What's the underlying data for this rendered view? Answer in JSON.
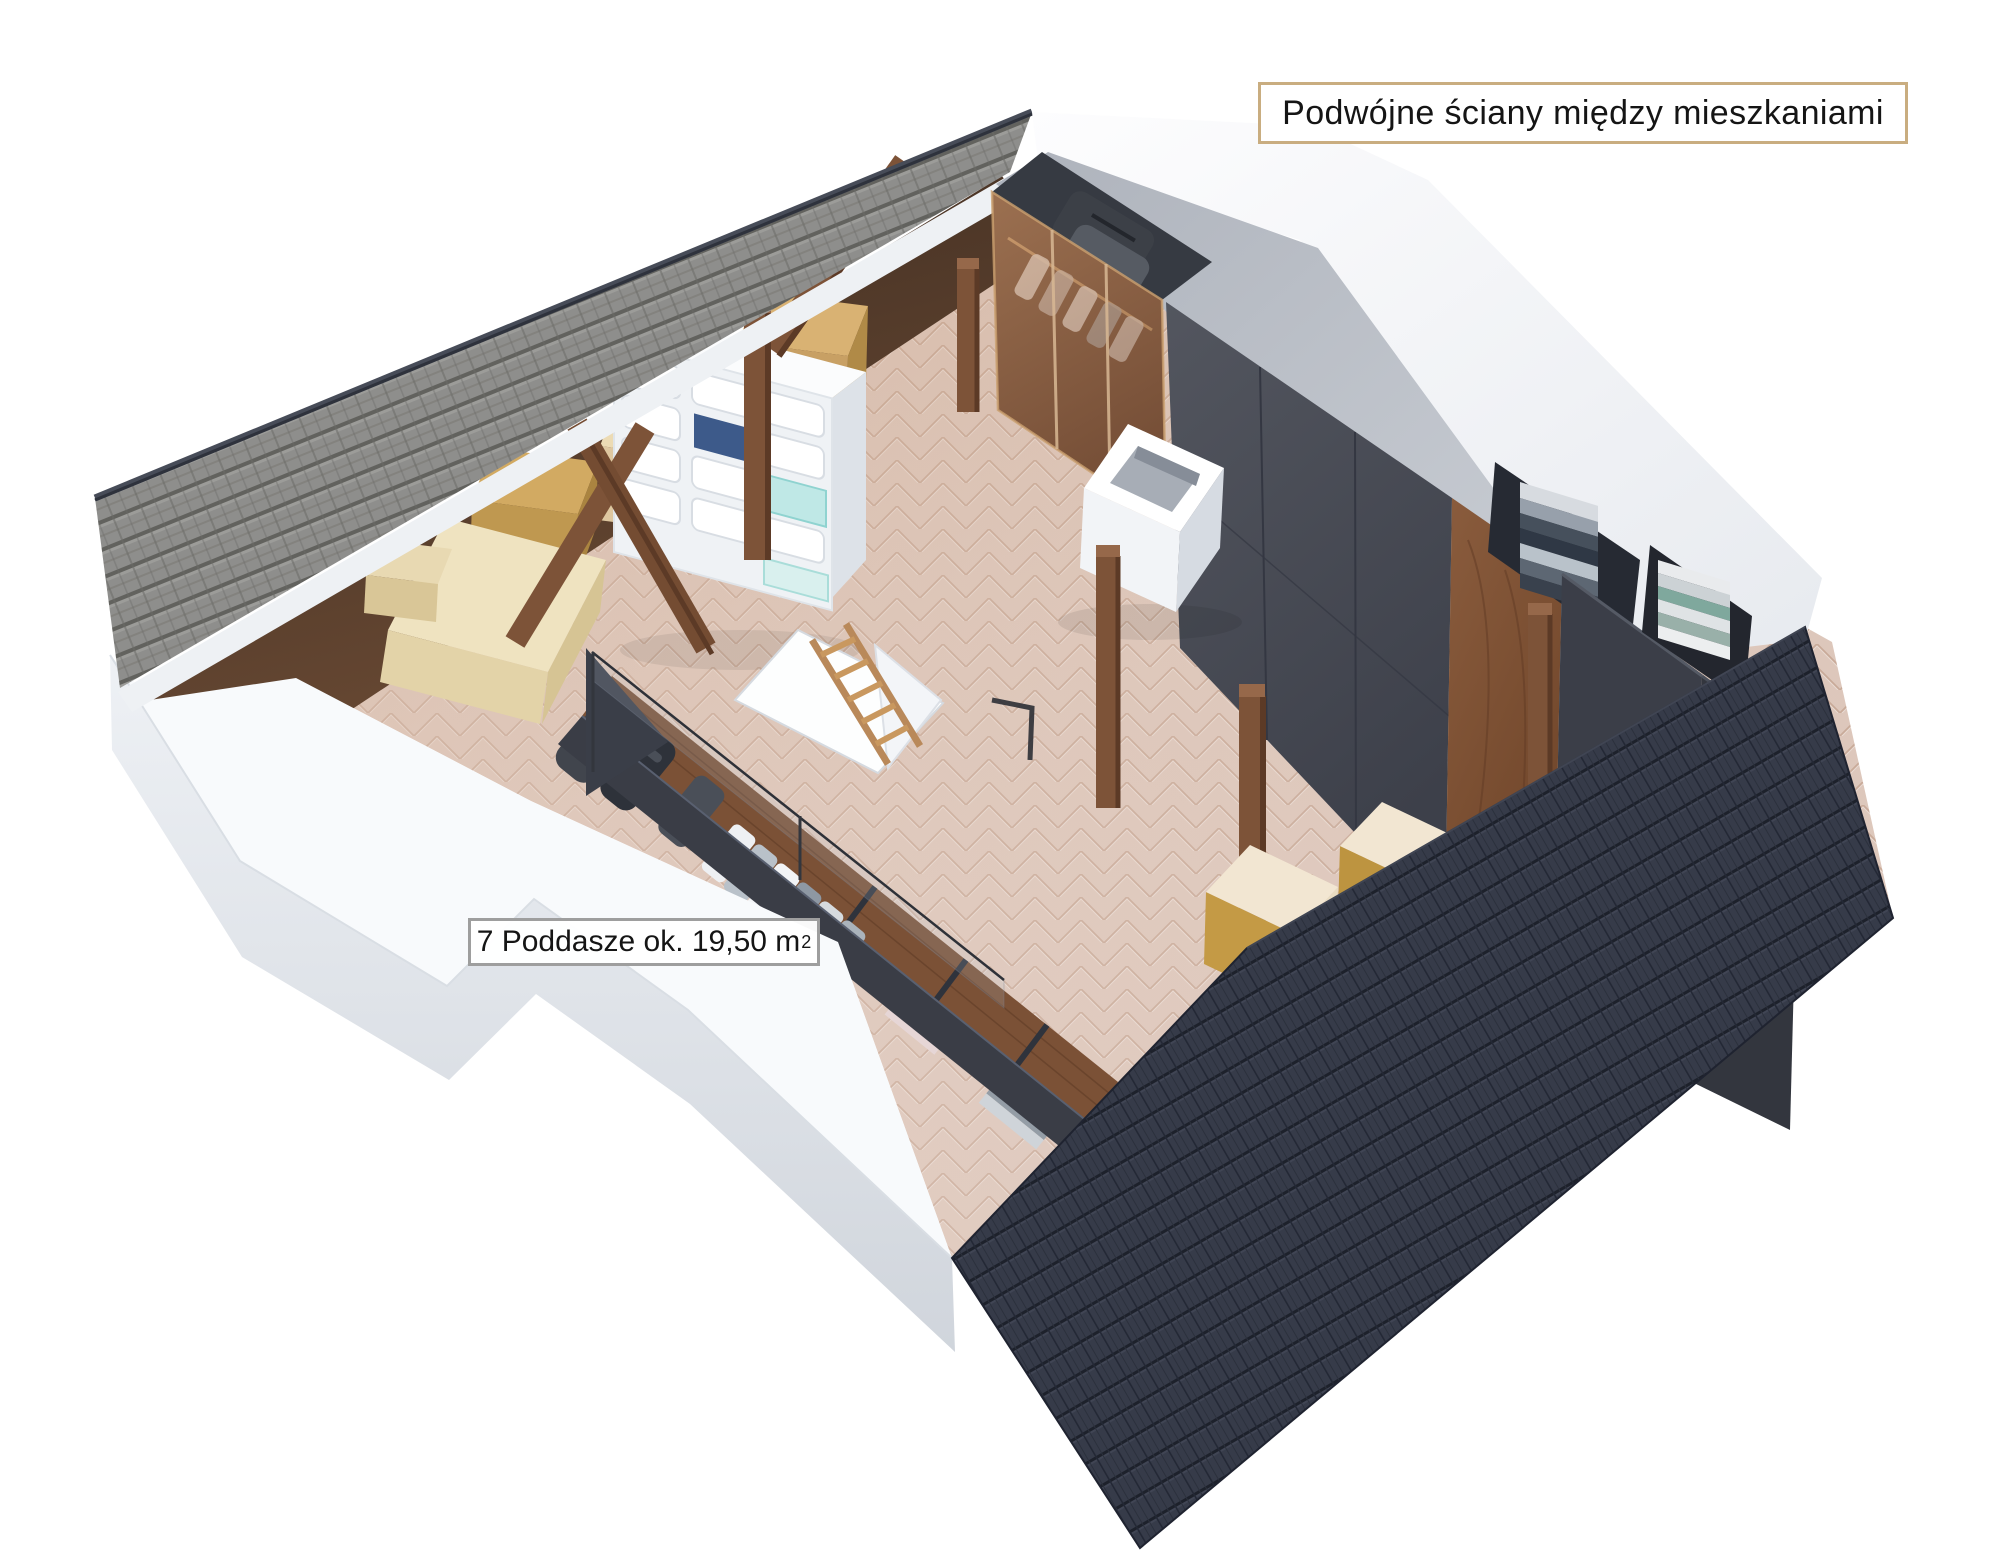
{
  "annotations": {
    "double_walls_label": "Podwójne ściany między mieszkaniami",
    "attic_area_label": {
      "prefix": "7 Poddasze ok. 19,50 m",
      "sup": "2"
    }
  },
  "palette": {
    "accent_border": "#c9ad80",
    "grey_border": "#9e9e9e",
    "text_color": "#151515",
    "roof_light": "#8e8e8c",
    "roof_dark": "#363b49",
    "floor_wood": "#dcc6ba",
    "wall_white": "#f8fafc",
    "wardrobe_grey": "#46494f",
    "walnut": "#7b5136",
    "glass_amber": "#b98a63",
    "box_tan": "#c8a064",
    "chimney_white": "#f2f4f7",
    "stool_cream": "#f2e6d2",
    "stool_gold": "#c49a45"
  }
}
